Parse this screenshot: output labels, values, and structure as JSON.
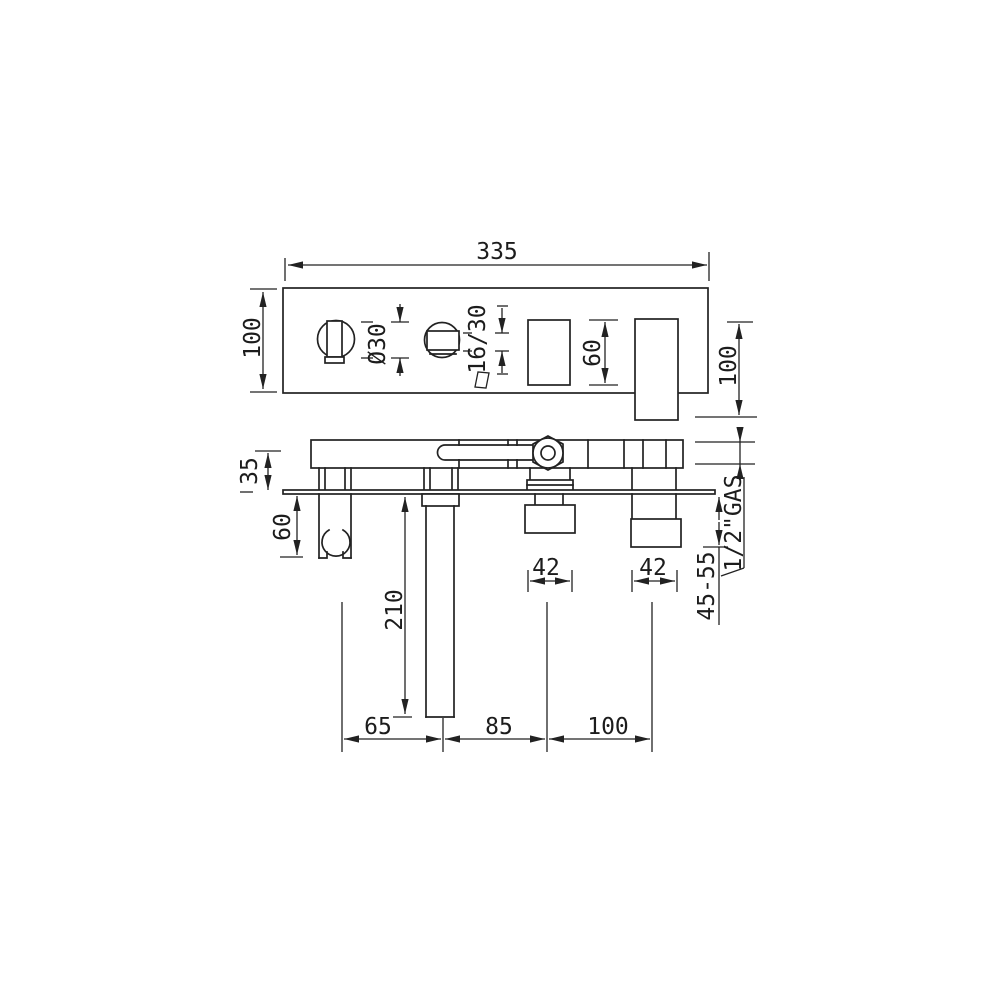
{
  "drawing": {
    "type": "technical-dimension-drawing",
    "subject": "wall-mounted bath mixer with hand shower (front view and side section view)",
    "colors": {
      "background": "#ffffff",
      "line": "#222222"
    }
  },
  "front_view": {
    "overall_width": "335",
    "plate_height": "100",
    "handle_diameter": "Ø30",
    "handle_slot": "16/30",
    "opening_height": "60",
    "spout_height": "100"
  },
  "side_view": {
    "body_depth": "35",
    "holder_drop": "60",
    "spout_drop": "210",
    "outlet_width_left": "42",
    "outlet_width_right": "42",
    "projection_range": "45-55",
    "thread_label": "1/2\"GAS",
    "spacing_left": "65",
    "spacing_mid": "85",
    "spacing_right": "100"
  }
}
